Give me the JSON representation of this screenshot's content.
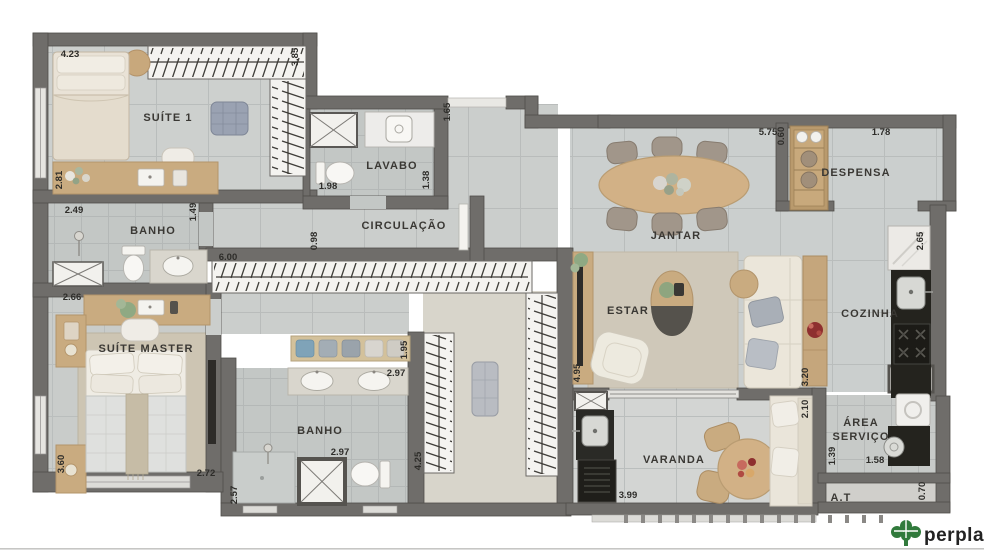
{
  "brand": {
    "name": "perplan"
  },
  "rooms": {
    "suite1": "SUÍTE 1",
    "banho1": "BANHO",
    "lavabo": "LAVABO",
    "circulacao": "CIRCULAÇÃO",
    "jantar": "JANTAR",
    "despensa": "DESPENSA",
    "estar": "ESTAR",
    "cozinha": "COZINHA",
    "suiteMaster": "SUÍTE MASTER",
    "banho2": "BANHO",
    "varanda": "VARANDA",
    "areaServicoLine1": "ÁREA",
    "areaServicoLine2": "SERVIÇO",
    "at": "A.T"
  },
  "dimensions": [
    {
      "id": "suite1-top",
      "value": "4.23"
    },
    {
      "id": "suite1-right",
      "value": "3.85"
    },
    {
      "id": "suite1-left",
      "value": "2.81"
    },
    {
      "id": "banho1-width",
      "value": "2.49"
    },
    {
      "id": "banho1-height",
      "value": "1.49"
    },
    {
      "id": "lavabo-width",
      "value": "1.98"
    },
    {
      "id": "lavabo-height",
      "value": "1.38"
    },
    {
      "id": "entry-depth",
      "value": "1.65"
    },
    {
      "id": "circulacao-width",
      "value": "0.98"
    },
    {
      "id": "closet-corridor",
      "value": "6.00"
    },
    {
      "id": "jantar-width",
      "value": "5.75"
    },
    {
      "id": "despensa-width",
      "value": "1.78"
    },
    {
      "id": "despensa-shelf",
      "value": "0.60"
    },
    {
      "id": "cozinha-depth",
      "value": "2.65"
    },
    {
      "id": "suite-master-top",
      "value": "2.66"
    },
    {
      "id": "suite-master-left",
      "value": "3.60"
    },
    {
      "id": "suite-master-bottom",
      "value": "2.72"
    },
    {
      "id": "banho2-left",
      "value": "2.57"
    },
    {
      "id": "banho2-counter",
      "value": "2.97"
    },
    {
      "id": "banho2-shelf",
      "value": "1.95"
    },
    {
      "id": "banho2-bottom",
      "value": "2.97"
    },
    {
      "id": "closet-left",
      "value": "4.25"
    },
    {
      "id": "estar-left",
      "value": "4.95"
    },
    {
      "id": "estar-right",
      "value": "3.20"
    },
    {
      "id": "varanda-right",
      "value": "2.10"
    },
    {
      "id": "varanda-bottom",
      "value": "3.99"
    },
    {
      "id": "area-servico-left",
      "value": "1.39"
    },
    {
      "id": "area-servico-bottom",
      "value": "1.58"
    },
    {
      "id": "at-right",
      "value": "0.70"
    }
  ]
}
